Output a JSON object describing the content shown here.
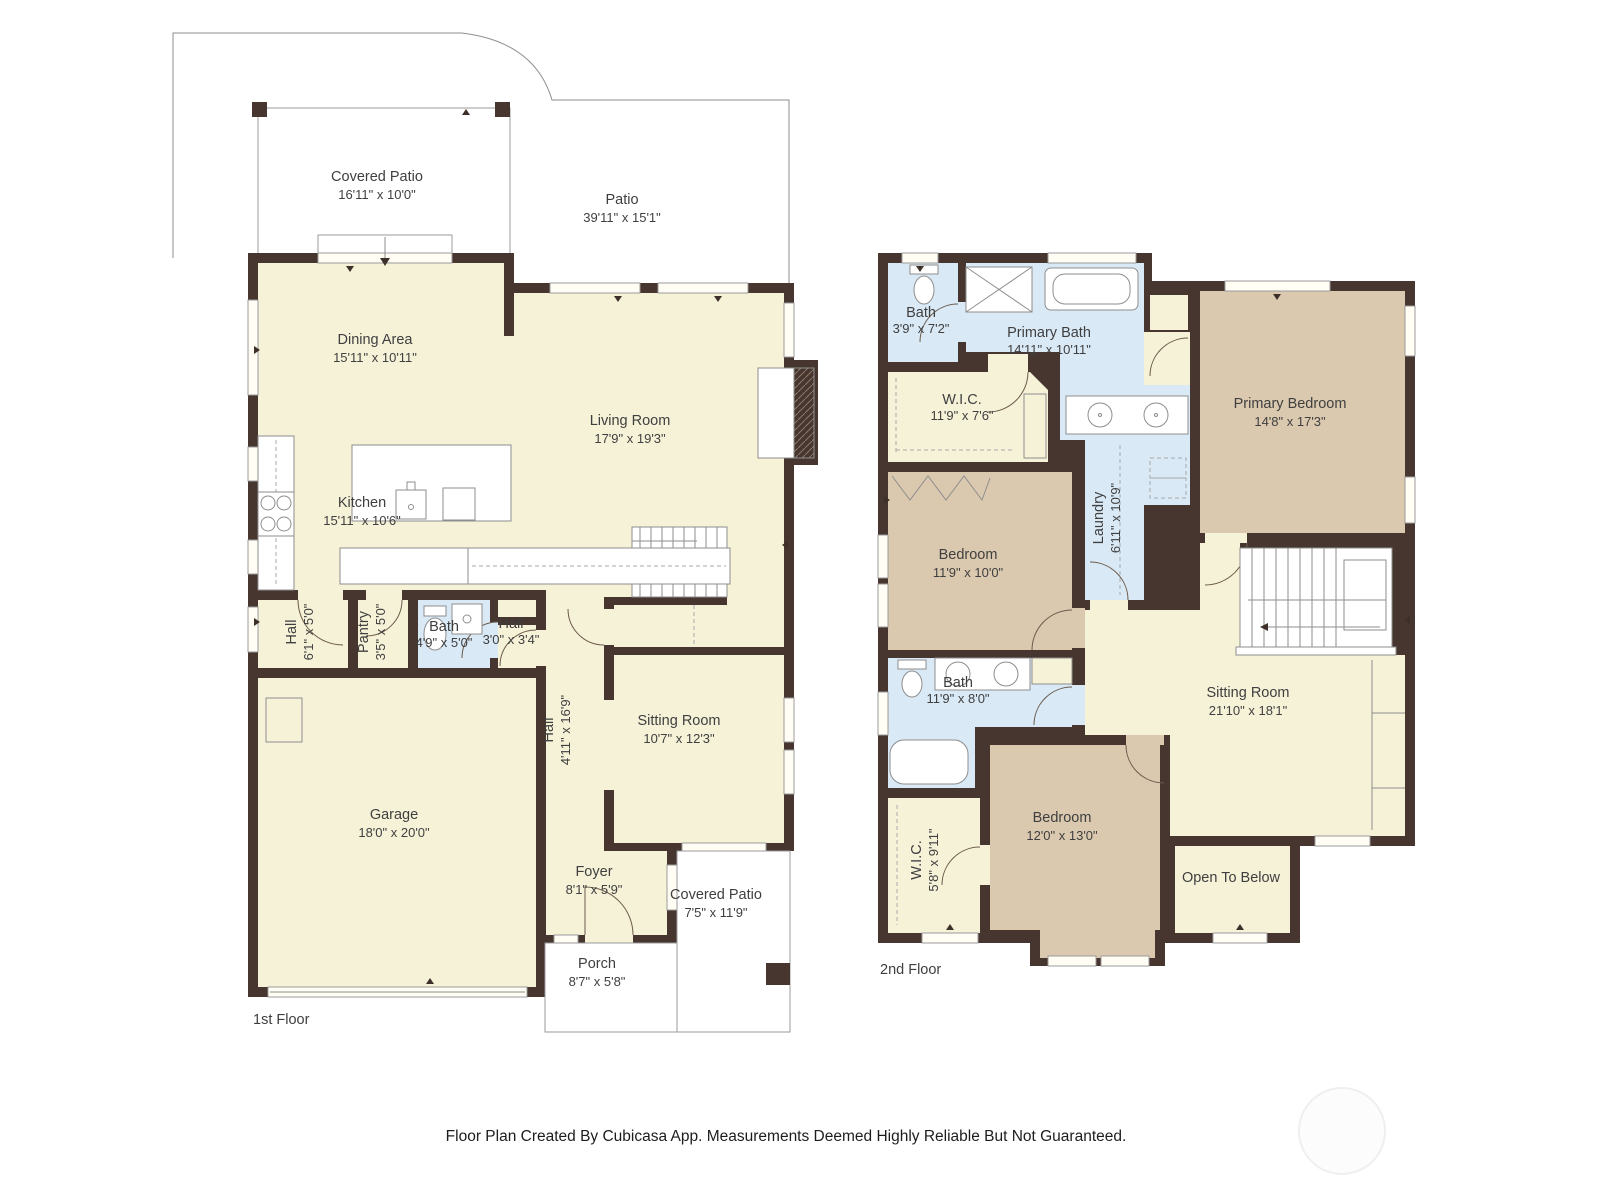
{
  "footer": {
    "text": "Floor Plan Created By Cubicasa App. Measurements Deemed Highly Reliable But Not Guaranteed."
  },
  "floor1": {
    "label": "1st Floor",
    "rooms": {
      "covered_patio": {
        "name": "Covered Patio",
        "dims": "16'11\" x 10'0\""
      },
      "patio": {
        "name": "Patio",
        "dims": "39'11\" x 15'1\""
      },
      "dining": {
        "name": "Dining Area",
        "dims": "15'11\" x 10'11\""
      },
      "living": {
        "name": "Living Room",
        "dims": "17'9\" x 19'3\""
      },
      "kitchen": {
        "name": "Kitchen",
        "dims": "15'11\" x 10'6\""
      },
      "hall_a": {
        "name": "Hall",
        "dims": "6'1\" x 5'0\""
      },
      "pantry": {
        "name": "Pantry",
        "dims": "3'5\" x 5'0\""
      },
      "bath": {
        "name": "Bath",
        "dims": "4'9\" x 5'0\""
      },
      "hall_b": {
        "name": "Hall",
        "dims": "3'0\" x 3'4\""
      },
      "garage": {
        "name": "Garage",
        "dims": "18'0\" x 20'0\""
      },
      "hall_c": {
        "name": "Hall",
        "dims": "4'11\" x 16'9\""
      },
      "sitting": {
        "name": "Sitting Room",
        "dims": "10'7\" x 12'3\""
      },
      "foyer": {
        "name": "Foyer",
        "dims": "8'1\" x 5'9\""
      },
      "covered_patio_b": {
        "name": "Covered Patio",
        "dims": "7'5\" x 11'9\""
      },
      "porch": {
        "name": "Porch",
        "dims": "8'7\" x 5'8\""
      }
    }
  },
  "floor2": {
    "label": "2nd Floor",
    "rooms": {
      "bath_a": {
        "name": "Bath",
        "dims": "3'9\" x 7'2\""
      },
      "primary_bath": {
        "name": "Primary Bath",
        "dims": "14'11\" x 10'11\""
      },
      "wic_a": {
        "name": "W.I.C.",
        "dims": "11'9\" x 7'6\""
      },
      "primary_bedroom": {
        "name": "Primary Bedroom",
        "dims": "14'8\" x 17'3\""
      },
      "laundry": {
        "name": "Laundry",
        "dims": "6'11\" x 10'9\""
      },
      "bedroom_a": {
        "name": "Bedroom",
        "dims": "11'9\" x 10'0\""
      },
      "bath_b": {
        "name": "Bath",
        "dims": "11'9\" x 8'0\""
      },
      "wic_b": {
        "name": "W.I.C.",
        "dims": "5'8\" x 9'11\""
      },
      "bedroom_b": {
        "name": "Bedroom",
        "dims": "12'0\" x 13'0\""
      },
      "sitting": {
        "name": "Sitting Room",
        "dims": "21'10\" x 18'1\""
      },
      "open_below": {
        "name": "Open To Below"
      }
    }
  }
}
